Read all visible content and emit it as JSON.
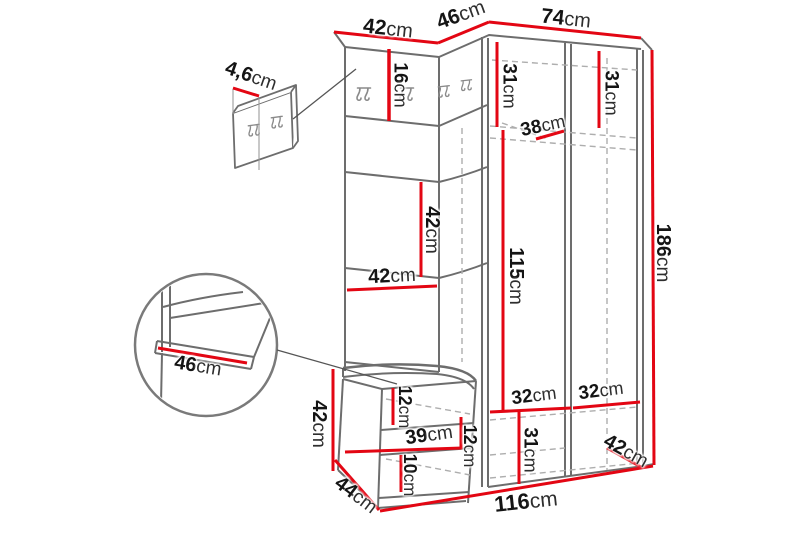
{
  "diagram": {
    "type": "furniture-dimension-diagram",
    "description": "Hallway furniture set (hall unit with coat hooks, wardrobe and bench) with dimension callouts",
    "accent_color": "#e30613",
    "line_color": "#6d6d6d",
    "background_color": "#ffffff",
    "labels": {
      "panel_thickness": {
        "value": "4,6",
        "unit": "cm"
      },
      "top_left_width": {
        "value": "42",
        "unit": "cm"
      },
      "top_mid_width": {
        "value": "46",
        "unit": "cm"
      },
      "top_right_width": {
        "value": "74",
        "unit": "cm"
      },
      "hook_section_height": {
        "value": "16",
        "unit": "cm"
      },
      "wardrobe_left_width": {
        "value": "31",
        "unit": "cm"
      },
      "wardrobe_right_width": {
        "value": "31",
        "unit": "cm"
      },
      "wardrobe_depth": {
        "value": "38",
        "unit": "cm"
      },
      "panel_section_height": {
        "value": "42",
        "unit": "cm"
      },
      "panel_width": {
        "value": "42",
        "unit": "cm"
      },
      "wardrobe_inner_height": {
        "value": "115",
        "unit": "cm"
      },
      "total_height": {
        "value": "186",
        "unit": "cm"
      },
      "seat_depth_detail": {
        "value": "46",
        "unit": "cm"
      },
      "bench_height": {
        "value": "42",
        "unit": "cm"
      },
      "bench_top_height": {
        "value": "12",
        "unit": "cm"
      },
      "drawer_width": {
        "value": "39",
        "unit": "cm"
      },
      "bench_right_height": {
        "value": "12",
        "unit": "cm"
      },
      "drawer_height": {
        "value": "10",
        "unit": "cm"
      },
      "bottom_left_width": {
        "value": "32",
        "unit": "cm"
      },
      "bottom_right_width": {
        "value": "32",
        "unit": "cm"
      },
      "bottom_section_height": {
        "value": "31",
        "unit": "cm"
      },
      "bottom_depth": {
        "value": "42",
        "unit": "cm"
      },
      "bench_depth": {
        "value": "44",
        "unit": "cm"
      },
      "total_width": {
        "value": "116",
        "unit": "cm"
      }
    }
  }
}
